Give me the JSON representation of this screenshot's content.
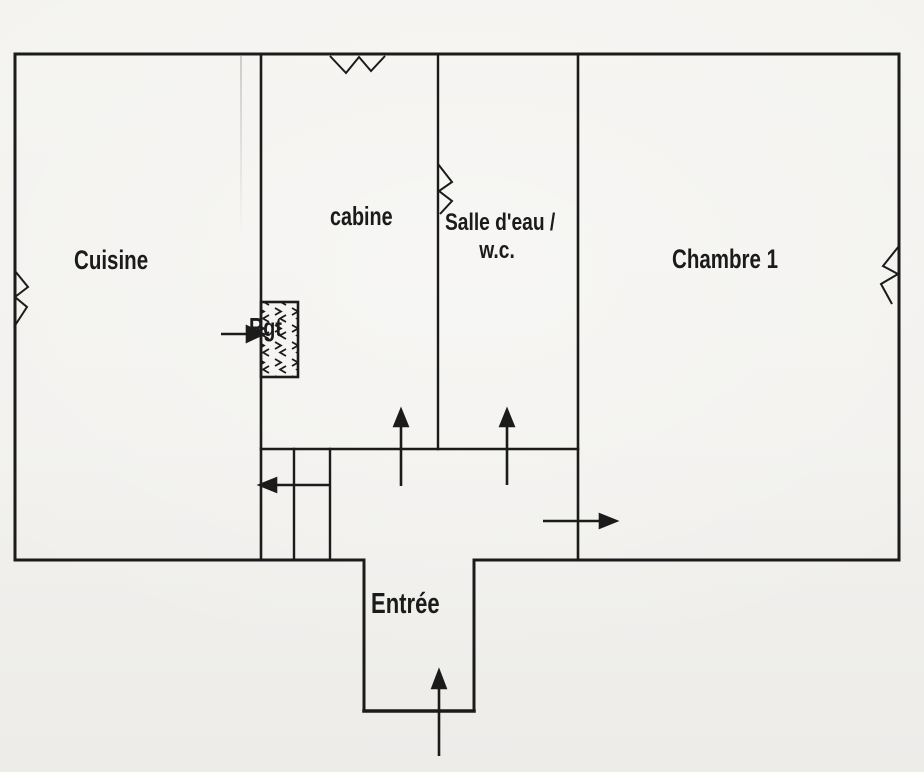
{
  "colors": {
    "paper": "#f2f1ee",
    "ink": "#1b1b1b"
  },
  "plan": {
    "rooms": {
      "cuisine": {
        "label": "Cuisine"
      },
      "cabine": {
        "label": "cabine"
      },
      "salle_deau_wc": {
        "line1": "Salle d'eau /",
        "line2": "w.c."
      },
      "chambre_1": {
        "label": "Chambre 1"
      },
      "rangement": {
        "label": "Rgt"
      },
      "entree": {
        "label": "Entrée"
      }
    },
    "symbols": {
      "window_marks": [
        "left-wall-window",
        "top-wall-window",
        "salle-deau-wall-window",
        "right-wall-window"
      ],
      "direction_arrows": [
        "entry-arrow",
        "hall-to-cabine-arrow",
        "hall-to-salle-deau-arrow",
        "hall-to-chambre-arrow",
        "closet-arrow",
        "rangement-arrow"
      ]
    }
  }
}
